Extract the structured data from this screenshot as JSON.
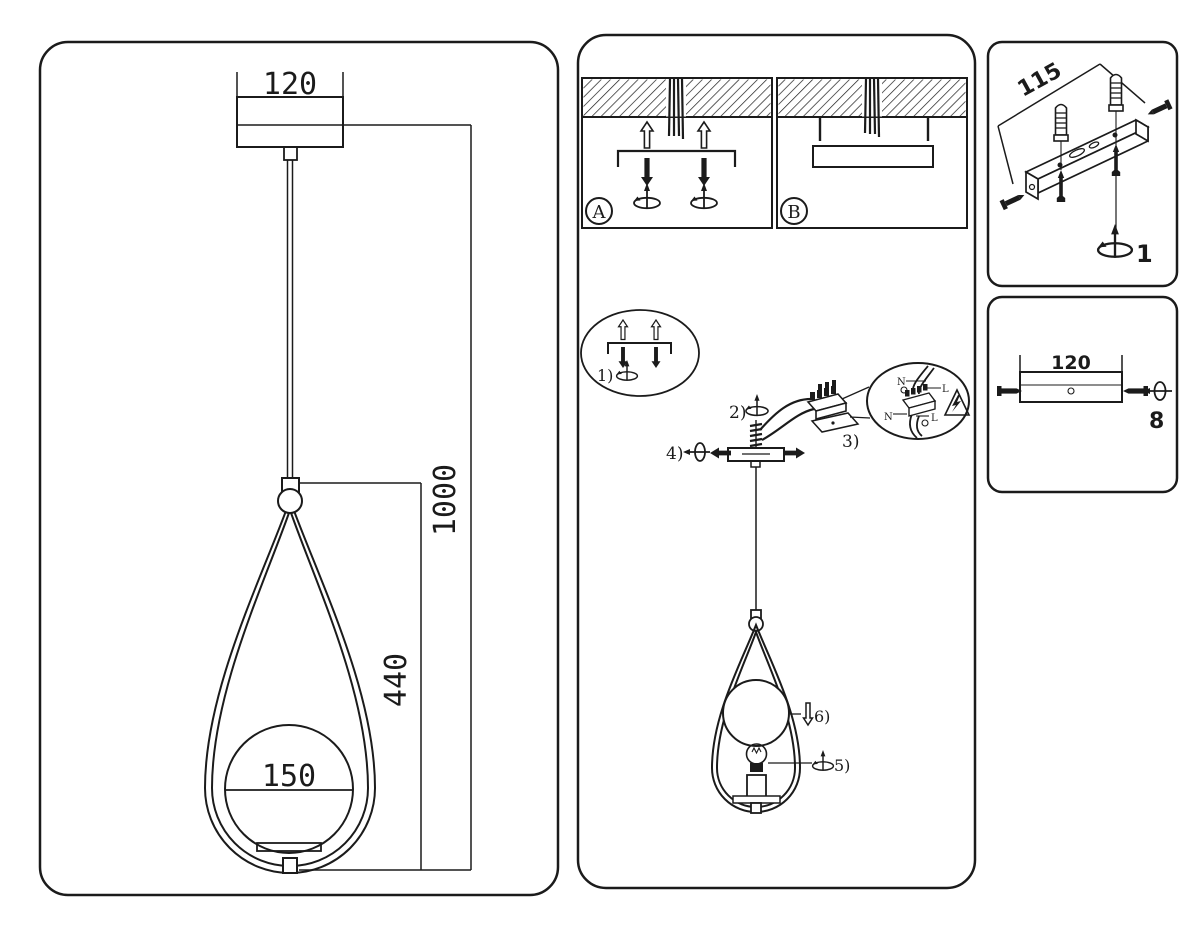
{
  "document": {
    "type": "pendant-lamp-installation-sheet"
  },
  "colors": {
    "line": "#1b1b1b",
    "background": "#ffffff"
  },
  "panels": {
    "left": {
      "dims": {
        "canopy_width": "120",
        "drop_height": "1000",
        "frame_height": "440",
        "globe_diameter": "150"
      }
    },
    "middle": {
      "variant_a": "A",
      "variant_b": "B",
      "steps": {
        "s1": "1)",
        "s2": "2)",
        "s3": "3)",
        "s4": "4)",
        "s5": "5)",
        "s6": "6)"
      },
      "wiring": {
        "n_top": "N",
        "l_top": "L",
        "n_bottom": "N",
        "l_bottom": "L"
      }
    },
    "right_top": {
      "bracket_length": "115",
      "step": "1"
    },
    "right_bottom": {
      "canopy_width": "120",
      "step": "8"
    }
  }
}
